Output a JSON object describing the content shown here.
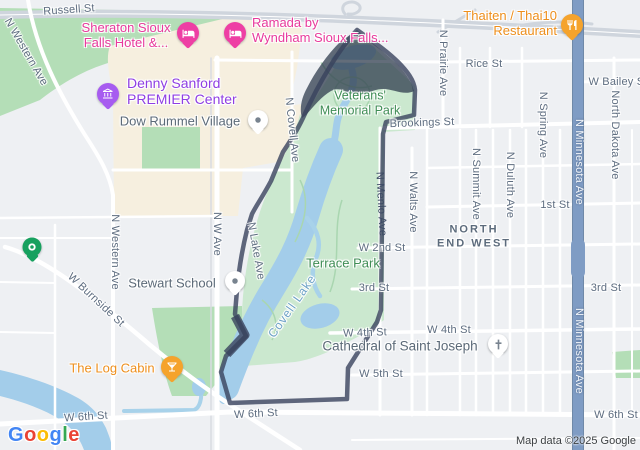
{
  "attribution": {
    "text": "Map data ©2025 Google"
  },
  "logo": {
    "text": "Google",
    "letters": [
      "G",
      "o",
      "o",
      "g",
      "l",
      "e"
    ],
    "letter_colors": [
      "#4285F4",
      "#EA4335",
      "#FBBC05",
      "#4285F4",
      "#34A853",
      "#EA4335"
    ]
  },
  "streets": [
    {
      "text": "Russell St"
    },
    {
      "text": "Rice St"
    },
    {
      "text": "W Bailey St"
    },
    {
      "text": "Brookings St"
    },
    {
      "text": "1st St"
    },
    {
      "text": "W 2nd St"
    },
    {
      "text": "3rd St"
    },
    {
      "text": "3rd St"
    },
    {
      "text": "W 4th St"
    },
    {
      "text": "W 4th St"
    },
    {
      "text": "W 5th St"
    },
    {
      "text": "W 6th St"
    },
    {
      "text": "W 6th St"
    },
    {
      "text": "W 6th St"
    },
    {
      "text": "W Burnside St"
    }
  ],
  "avenues": [
    {
      "text": "N Western Ave"
    },
    {
      "text": "N Western Ave"
    },
    {
      "text": "N W Ave"
    },
    {
      "text": "N Covell Ave"
    },
    {
      "text": "N Lake Ave"
    },
    {
      "text": "N Menlo Ave"
    },
    {
      "text": "N Walts Ave"
    },
    {
      "text": "N Summit Ave"
    },
    {
      "text": "N Duluth Ave"
    },
    {
      "text": "N Spring Ave"
    },
    {
      "text": "North Dakota Ave"
    },
    {
      "text": "N Prairie Ave"
    },
    {
      "text": "N Minnesota Ave"
    },
    {
      "text": "N Minnesota Ave"
    }
  ],
  "pois": {
    "sheraton": {
      "lines": [
        "Sheraton Sioux",
        "Falls Hotel &..."
      ]
    },
    "ramada": {
      "lines": [
        "Ramada by",
        "Wyndham Sioux Falls..."
      ]
    },
    "thaiten": {
      "lines": [
        "Thaiten / Thai10",
        "Restaurant"
      ]
    },
    "denny": {
      "lines": [
        "Denny Sanford",
        "PREMIER Center"
      ]
    },
    "dow": {
      "text": "Dow Rummel Village"
    },
    "veterans": {
      "lines": [
        "Veterans'",
        "Memorial Park"
      ]
    },
    "terrace": {
      "text": "Terrace Park"
    },
    "stewart": {
      "text": "Stewart School"
    },
    "cathedral": {
      "text": "Cathedral of Saint Joseph"
    },
    "logcabin": {
      "text": "The Log Cabin"
    },
    "covell_lake": {
      "text": "Covell Lake"
    },
    "neighborhood": {
      "lines": [
        "NORTH",
        "END WEST"
      ]
    }
  },
  "icons": [
    "bed-icon",
    "restaurant-icon",
    "cocktail-icon",
    "building-icon",
    "dot-icon",
    "cross-icon",
    "ring-icon"
  ],
  "colors": {
    "land": "#eef0f3",
    "road": "#ffffff",
    "highway": "#cfd5dd",
    "park_light": "#cbe8cf",
    "park_dark": "#b4deb7",
    "commercial_area": "#f6efdf",
    "water": "#a3cdea",
    "boundary_stroke": "#4d5872",
    "boundary_fill": "rgba(47,60,78,0.75)",
    "blue_road": "#7f9cc4",
    "hotel_pink": "#e83a9c",
    "food_orange": "#ee8f1c",
    "venue_purple": "#8f3ee3",
    "park_label_green": "#3f8d55",
    "street_label": "#5e6d80",
    "water_label": "#6fa3c8",
    "neighborhood_label": "#5c6b7c"
  }
}
